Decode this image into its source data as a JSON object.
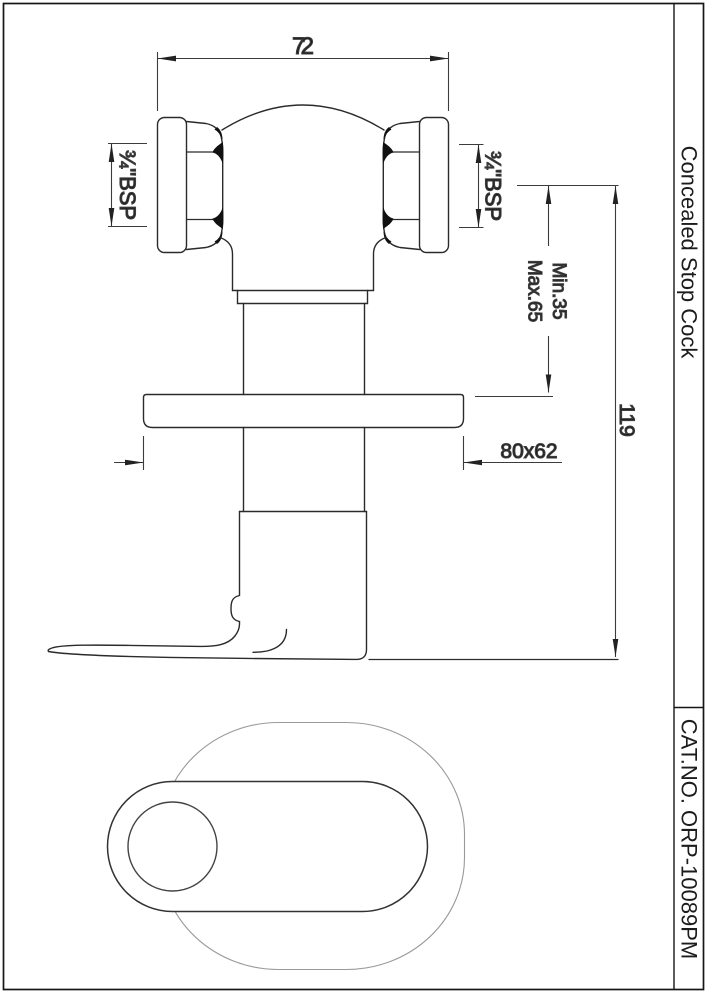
{
  "drawing": {
    "product_title": "Concealed Stop Cock",
    "catalog_number": "CAT.NO. ORP-10089PM",
    "dimensions": {
      "top_width": "72",
      "bsp_left": "¾\"BSP",
      "bsp_right": "¾\"BSP",
      "depth_min": "Min.35",
      "depth_max": "Max.65",
      "overall_height": "119",
      "flange_size": "80x62"
    },
    "colors": {
      "background": "#ffffff",
      "outline": "#2b2b2b",
      "dimension_line": "#3c3c3c",
      "hidden_outline": "#9a9a9a",
      "border": "#161616"
    }
  }
}
